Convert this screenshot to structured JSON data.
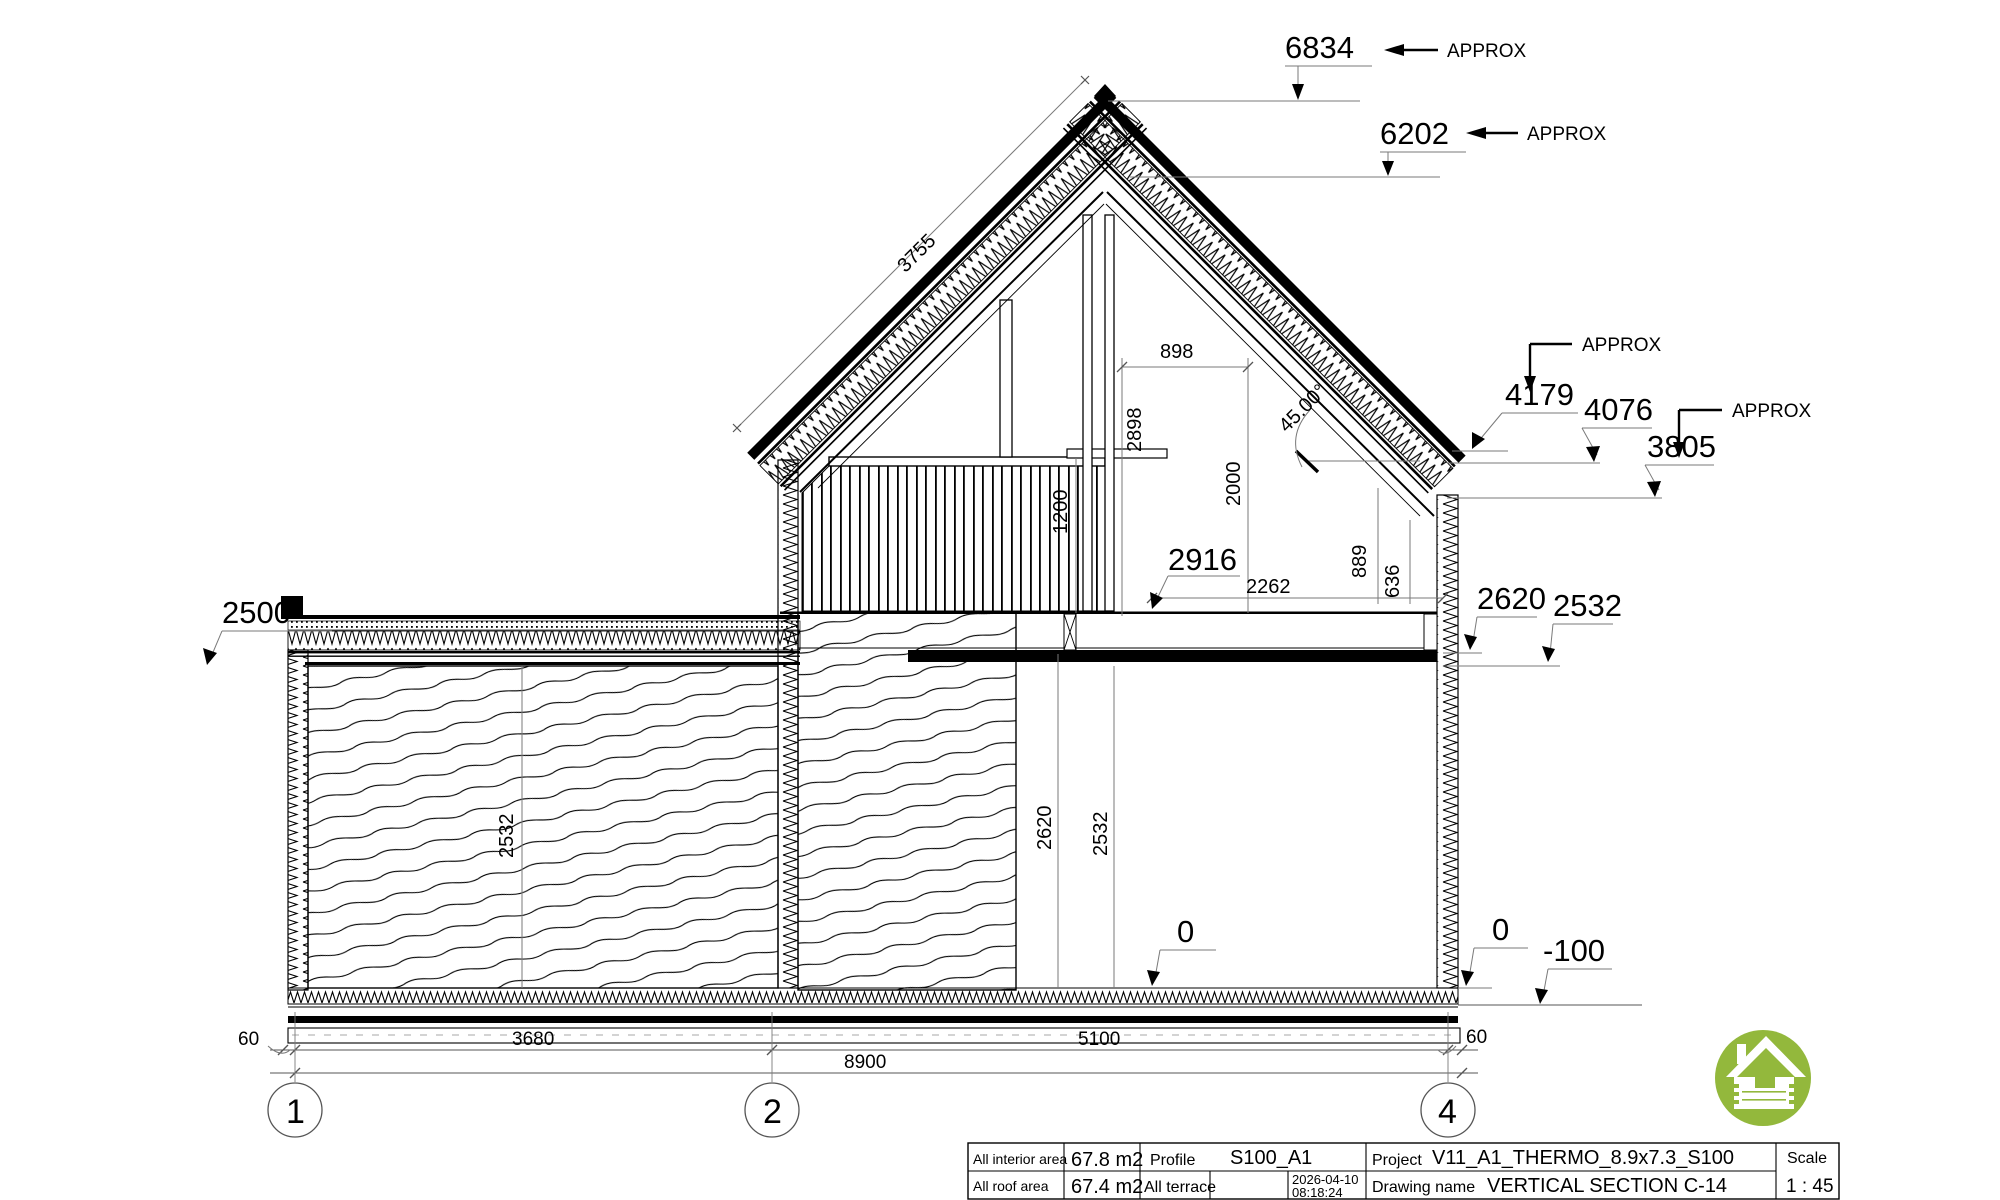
{
  "drawing": {
    "top_dims": {
      "ridge_total": "6834",
      "ridge_inner": "6202",
      "approx": "APPROX",
      "slope_length": "3755"
    },
    "attic_dims": {
      "d898": "898",
      "d2898": "2898",
      "d2000": "2000",
      "d1200": "1200",
      "angle": "45.00°",
      "d2916": "2916",
      "d2262": "2262",
      "d889": "889",
      "d636": "636"
    },
    "right_levels": {
      "approx_a": "APPROX",
      "l4179": "4179",
      "l4076": "4076",
      "approx_b": "APPROX",
      "l3805": "3805",
      "l2620": "2620",
      "l2532": "2532"
    },
    "left_levels": {
      "l2500": "2500"
    },
    "floor_dims": {
      "room_height": "2532",
      "mid_2620": "2620",
      "mid_2532": "2532"
    },
    "ground_levels": {
      "zero_left": "0",
      "zero_right": "0",
      "minus100": "-100"
    },
    "bottom_dims": {
      "margin_left": "60",
      "span_1_2": "3680",
      "span_2_4": "5100",
      "total": "8900",
      "margin_right": "60"
    },
    "grid": {
      "axis1": "1",
      "axis2": "2",
      "axis4": "4"
    }
  },
  "title_block": {
    "interior_area_label": "All interior area",
    "interior_area_value": "67.8 m2",
    "roof_area_label": "All roof area",
    "roof_area_value": "67.4 m2",
    "terrace_label": "All terrace",
    "terrace_value": "",
    "profile_label": "Profile",
    "profile_value": "S100_A1",
    "project_label": "Project",
    "project_value": "V11_A1_THERMO_8.9x7.3_S100",
    "drawing_name_label": "Drawing name",
    "drawing_name_value": "VERTICAL SECTION C-14",
    "date": "2026-04-10",
    "time": "08:18:24",
    "scale_label": "Scale",
    "scale_value": "1 : 45"
  },
  "logo": {
    "name": "log-house-logo",
    "color": "#93b83c"
  }
}
